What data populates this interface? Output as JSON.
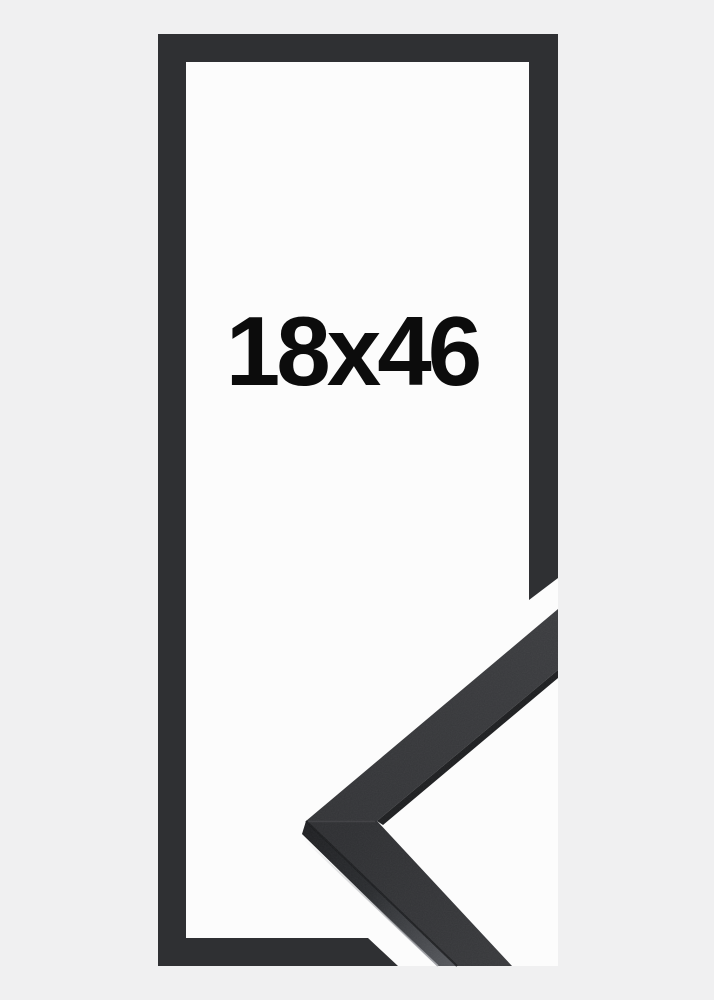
{
  "product_image": {
    "size_label": "18x46",
    "colors": {
      "background": "#f0f0f1",
      "frame": "#2f3033",
      "window": "#fcfcfc",
      "label": "#0c0c0c",
      "detail_face_dark": "#2e2f32",
      "detail_face_light": "#3b3c3f",
      "detail_side_dark": "#1f2023",
      "detail_side_light": "#55575c"
    }
  }
}
